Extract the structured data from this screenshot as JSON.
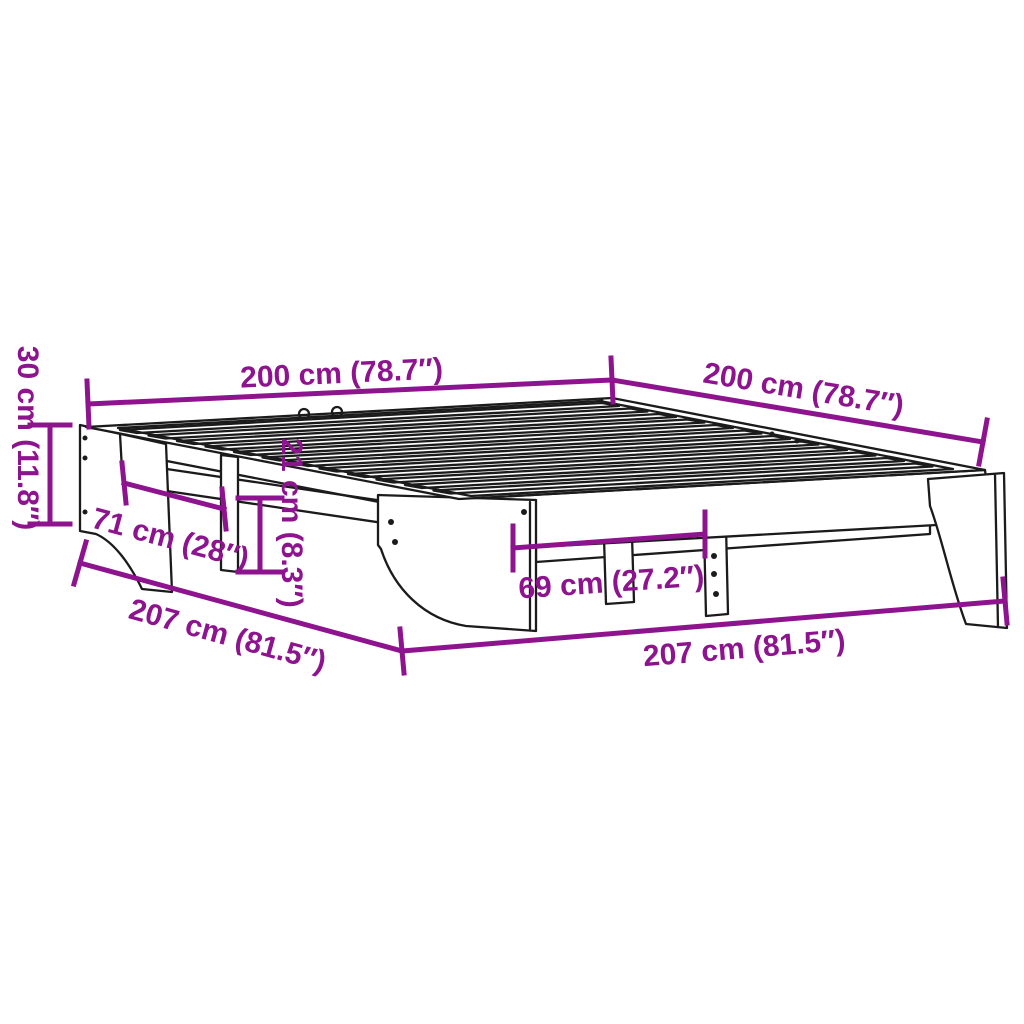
{
  "page": {
    "title": "Bed frame dimension diagram"
  },
  "diagram": {
    "product": "bed-frame-with-slats-line-drawing",
    "style": {
      "dimension_color": "#8E138E",
      "drawing_color": "#1b1b1b",
      "background": "#ffffff"
    },
    "dimensions": {
      "width_top_left": {
        "label": "200 cm (78.7″)"
      },
      "depth_top_right": {
        "label": "200 cm (78.7″)"
      },
      "height_left": {
        "label": "30 cm (11.8″)"
      },
      "panel_inset": {
        "label": "71 cm (28″)"
      },
      "clearance_height": {
        "label": "21 cm (8.3″)"
      },
      "leg_spacing": {
        "label": "69 cm (27.2″)"
      },
      "length_bottom_left": {
        "label": "207 cm (81.5″)"
      },
      "length_bottom_center": {
        "label": "207 cm (81.5″)"
      }
    }
  }
}
